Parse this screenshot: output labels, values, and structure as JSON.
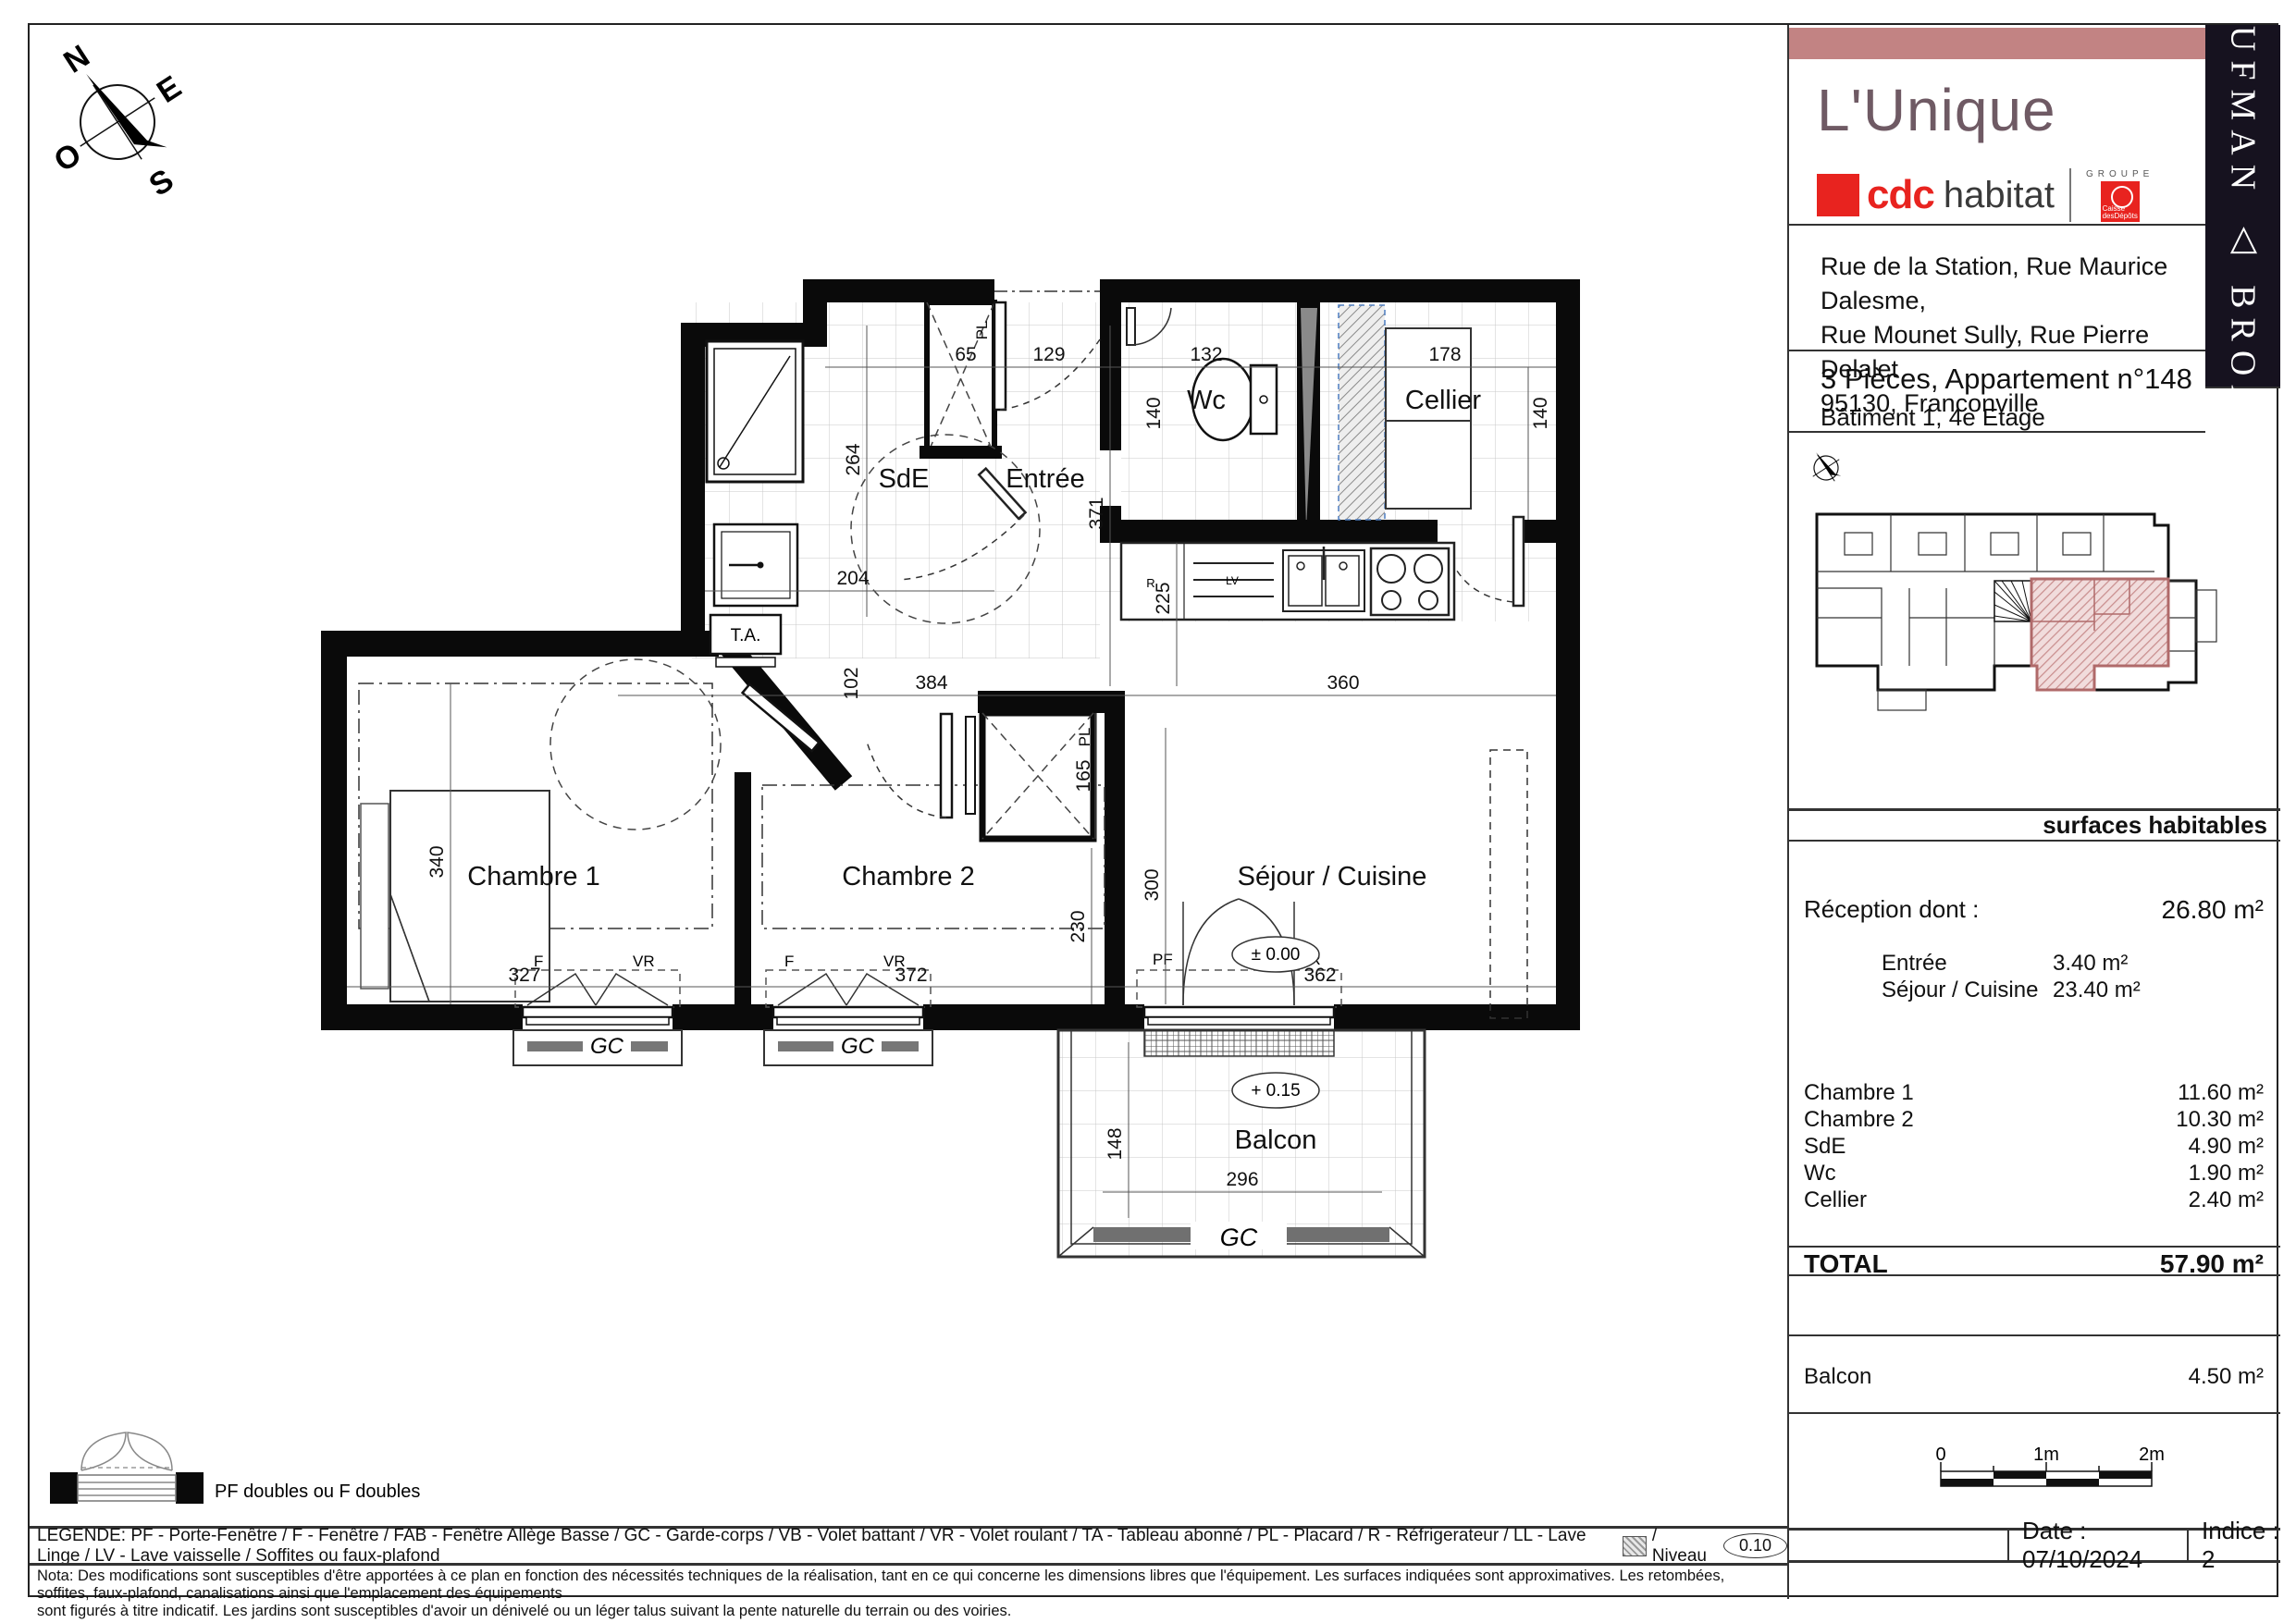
{
  "header": {
    "project": "L'Unique",
    "brand_cdc": "cdc",
    "brand_habitat": "habitat",
    "brand_groupe": "GROUPE",
    "brand_caisse": "Caisse",
    "brand_depots": "desDépôts",
    "kaufman_broad": "KAUFMAN △ BROAD",
    "address_line1": "Rue de la Station, Rue Maurice Dalesme,",
    "address_line2": "Rue Mounet Sully, Rue Pierre Delalet",
    "address_line3": "95130, Franconville",
    "apartment": "3 Pièces, Appartement n°148",
    "building": "Bâtiment 1, 4e Etage"
  },
  "surfaces": {
    "section_title": "surfaces habitables",
    "reception_label": "Réception dont :",
    "reception_value": "26.80 m²",
    "sub_rows": [
      {
        "label": "Entrée",
        "value": "3.40 m²"
      },
      {
        "label": "Séjour / Cuisine",
        "value": "23.40 m²"
      }
    ],
    "rows": [
      {
        "label": "Chambre 1",
        "value": "11.60 m²"
      },
      {
        "label": "Chambre 2",
        "value": "10.30 m²"
      },
      {
        "label": "SdE",
        "value": "4.90 m²"
      },
      {
        "label": "Wc",
        "value": "1.90 m²"
      },
      {
        "label": "Cellier",
        "value": "2.40 m²"
      }
    ],
    "total_label": "TOTAL",
    "total_value": "57.90 m²",
    "balcon_label": "Balcon",
    "balcon_value": "4.50 m²"
  },
  "scalebar": {
    "t0": "0",
    "t1": "1m",
    "t2": "2m"
  },
  "footer": {
    "date": "Date : 07/10/2024",
    "indice": "Indice : 2",
    "pf_doubles": "PF doubles ou F doubles",
    "legend": "LEGENDE:  PF - Porte-Fenêtre / F - Fenêtre / FAB - Fenêtre Allège Basse / GC - Garde-corps / VB - Volet battant / VR - Volet roulant / TA - Tableau abonné / PL - Placard / R - Réfrigerateur / LL - Lave Linge / LV - Lave vaisselle / Soffites ou faux-plafond",
    "legend_niveau": "/ Niveau",
    "niveau_value": "0.10",
    "nota_line1": "Nota: Des modifications sont susceptibles d'être apportées à ce plan en fonction des nécessités techniques de la réalisation, tant en ce qui concerne les dimensions libres que l'équipement. Les surfaces indiquées sont approximatives. Les retombées, soffites, faux-plafond, canalisations ainsi que l'emplacement des équipements",
    "nota_line2": "sont figurés à titre indicatif. Les jardins sont susceptibles d'avoir un dénivelé ou un léger talus suivant la pente naturelle du terrain ou des voiries."
  },
  "compass": {
    "n": "N",
    "e": "E",
    "s": "S",
    "o": "O"
  },
  "plan": {
    "rooms": {
      "sde": "SdE",
      "entree": "Entrée",
      "wc": "Wc",
      "cellier": "Cellier",
      "chambre1": "Chambre 1",
      "chambre2": "Chambre 2",
      "sejour": "Séjour / Cuisine",
      "balcon": "Balcon"
    },
    "dims": {
      "d65": "65",
      "d129": "129",
      "d132": "132",
      "d178": "178",
      "d140a": "140",
      "d140b": "140",
      "d264": "264",
      "d204": "204",
      "d371": "371",
      "d225": "225",
      "d102": "102",
      "d384": "384",
      "d360": "360",
      "d165": "165",
      "d340": "340",
      "d230": "230",
      "d300": "300",
      "d327": "327",
      "d372": "372",
      "d362": "362",
      "d148": "148",
      "d296": "296"
    },
    "labels": {
      "ta": "T.A.",
      "pl": "PL",
      "gc": "GC",
      "f": "F",
      "vr": "VR",
      "pf": "PF",
      "r": "R",
      "lv": "LV",
      "level0": "± 0.00",
      "level15": "+ 0.15"
    },
    "colors": {
      "unit_highlight": "#c98f8f",
      "accent_pink": "#c28383",
      "brand_red": "#e8231f"
    }
  }
}
